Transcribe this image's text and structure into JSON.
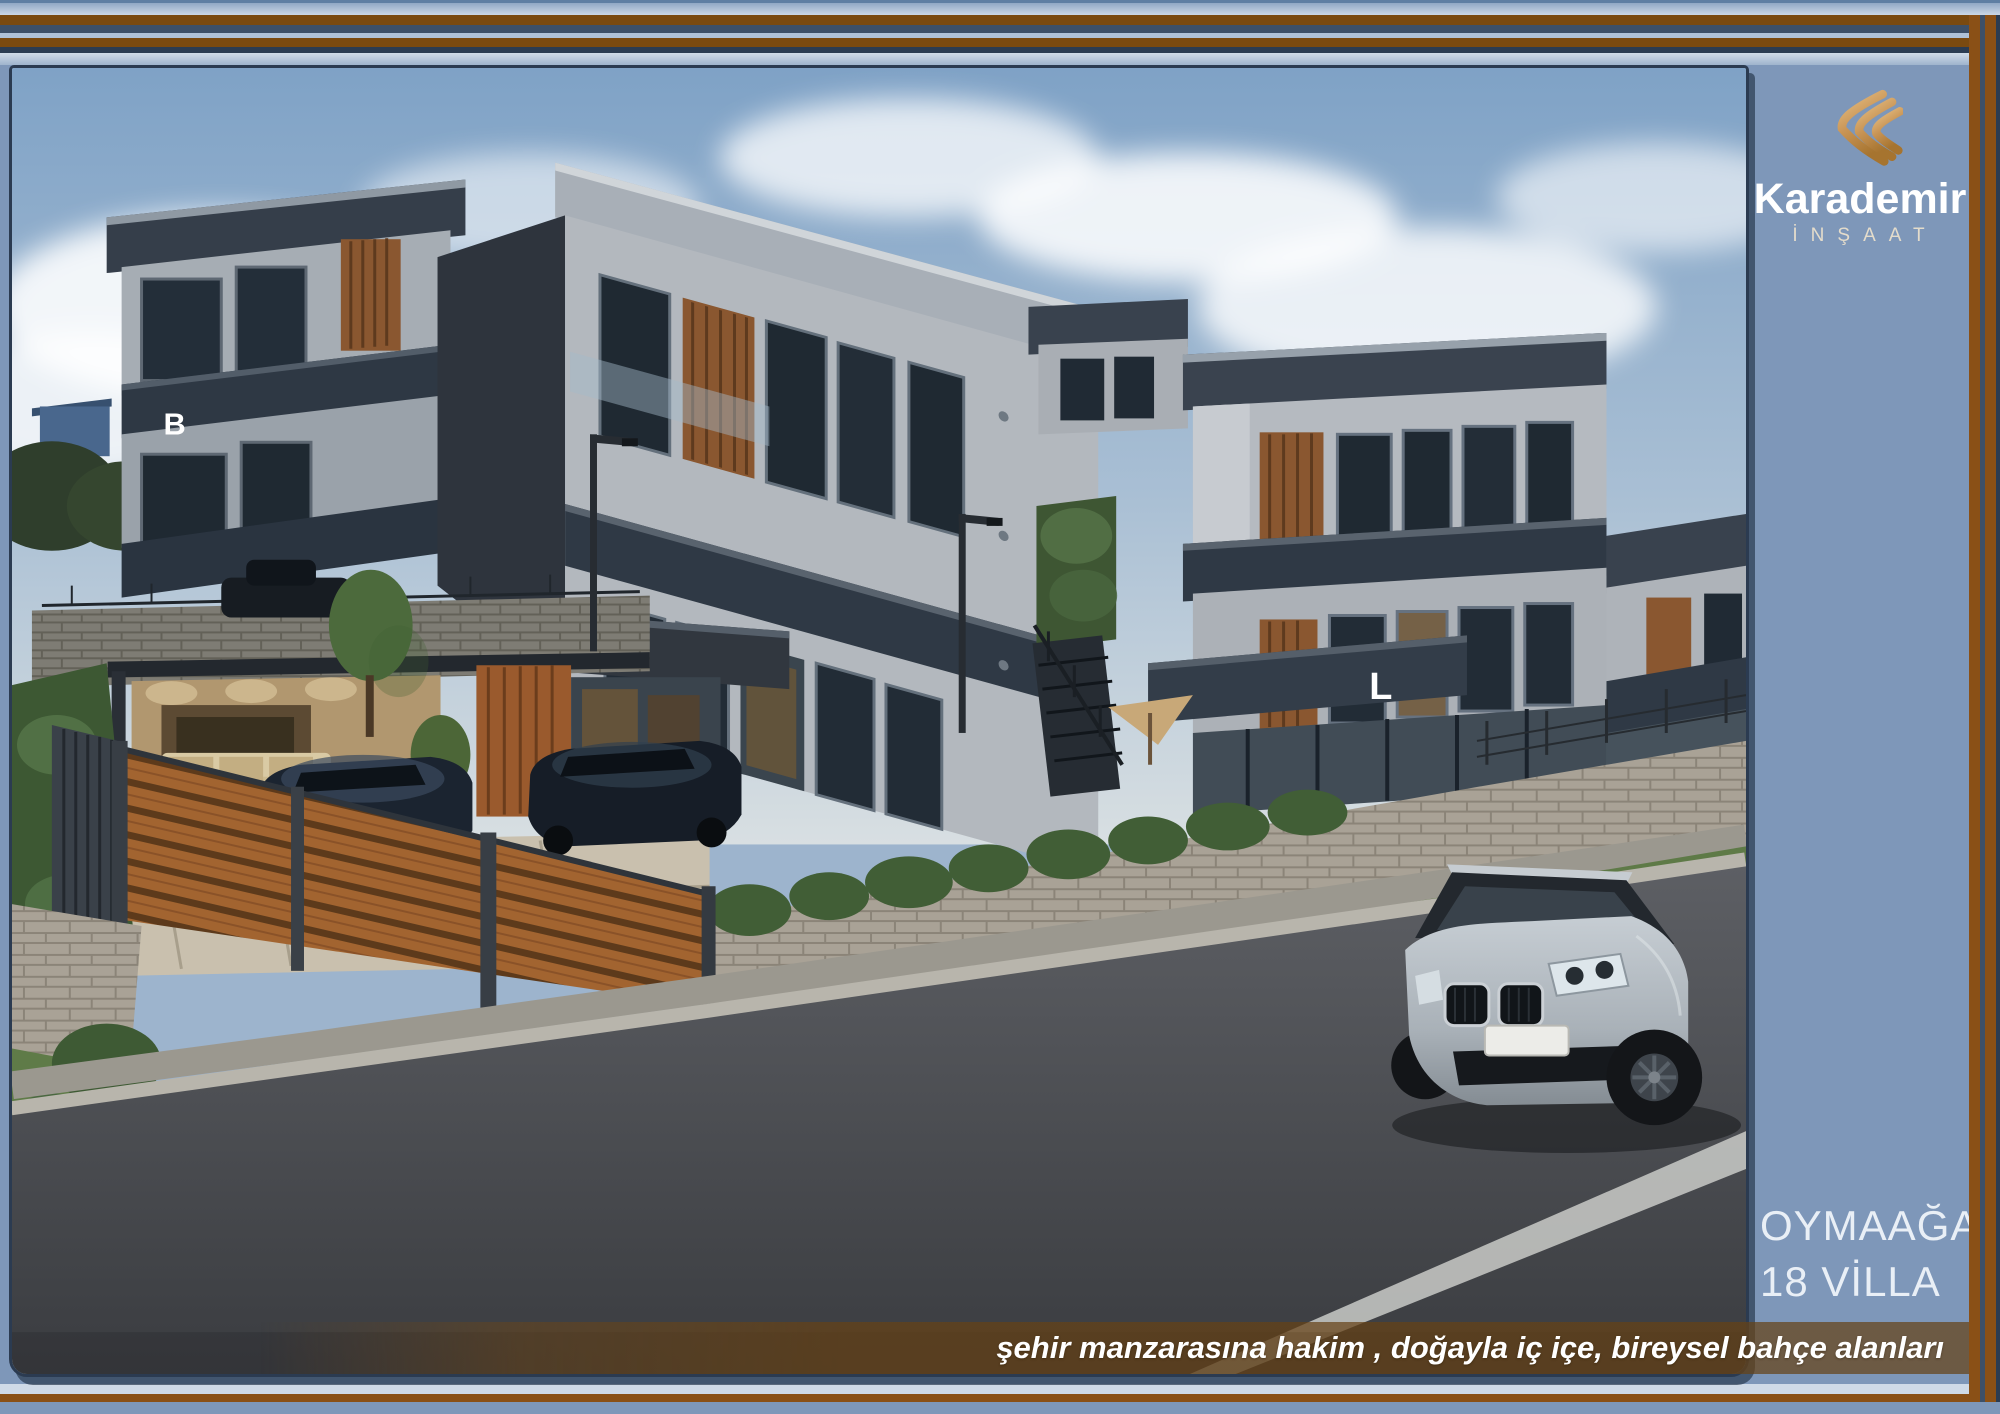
{
  "slide": {
    "background_color": "#7E97B9",
    "frame_brown": "#7A4A10",
    "frame_light_blue": "#C9D6E5",
    "frame_slate": "#3D5068",
    "frame_navy": "#2B3C52"
  },
  "logo": {
    "company": "Karademir",
    "division": "İNŞAAT",
    "mark_gold_light": "#E8C186",
    "mark_gold_dark": "#A6742F"
  },
  "project": {
    "location": "OYMAAĞAÇ",
    "units": "18 VİLLA"
  },
  "caption": {
    "text": "şehir manzarasına hakim , doğayla iç içe, bireysel bahçe alanları"
  },
  "rendering": {
    "labels": {
      "left_villa": "B",
      "center_villa": "K",
      "right_villa": "L"
    }
  }
}
